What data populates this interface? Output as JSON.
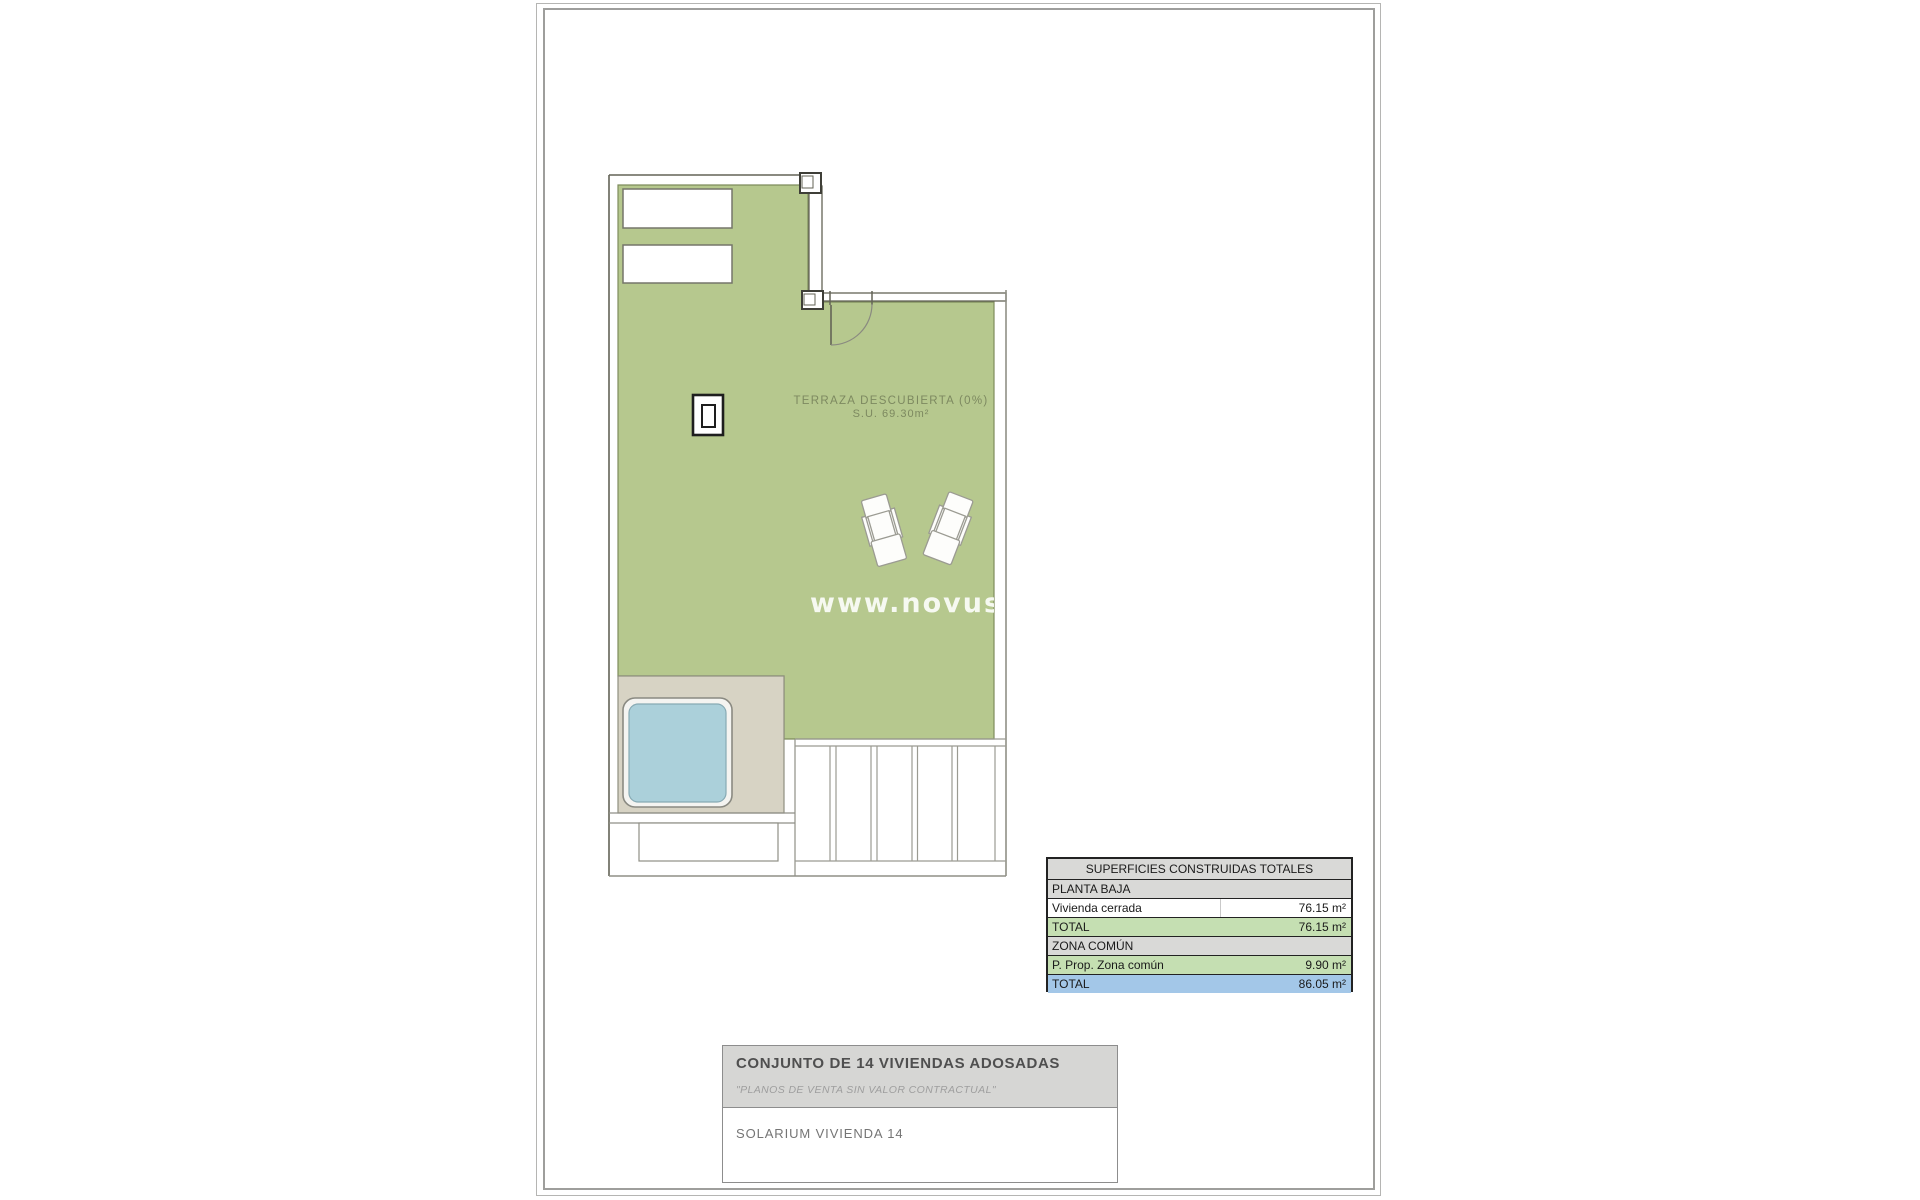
{
  "plan": {
    "terrace_label_line1": "TERRAZA DESCUBIERTA (0%)",
    "terrace_label_line2": "S.U. 69.30m²",
    "watermark": "www.novusha",
    "colors": {
      "terrace_green": "#b6c88e",
      "terrace_border": "#7e8c5c",
      "pool_deck_beige": "#d7d3c4",
      "pool_blue": "#abd0da",
      "wall_dark": "#636356",
      "line_gray": "#8f8f86"
    }
  },
  "areas_table": {
    "header": "SUPERFICIES CONSTRUIDAS TOTALES",
    "rows": [
      {
        "label": "PLANTA BAJA",
        "value": "",
        "style": "section"
      },
      {
        "label": "Vivienda cerrada",
        "value": "76.15 m²",
        "style": "plain"
      },
      {
        "label": "TOTAL",
        "value": "76.15 m²",
        "style": "green"
      },
      {
        "label": "ZONA COMÚN",
        "value": "",
        "style": "section"
      },
      {
        "label": "P. Prop. Zona común",
        "value": "9.90 m²",
        "style": "green"
      },
      {
        "label": "TOTAL",
        "value": "86.05 m²",
        "style": "blue"
      }
    ],
    "row_colors": {
      "section": "#d9d9d7",
      "green": "#c5dfb2",
      "blue": "#a3c7e8"
    }
  },
  "title_block": {
    "project": "CONJUNTO DE 14 VIVIENDAS ADOSADAS",
    "disclaimer": "\"PLANOS DE VENTA SIN VALOR CONTRACTUAL\"",
    "sheet": "SOLARIUM VIVIENDA 14"
  }
}
